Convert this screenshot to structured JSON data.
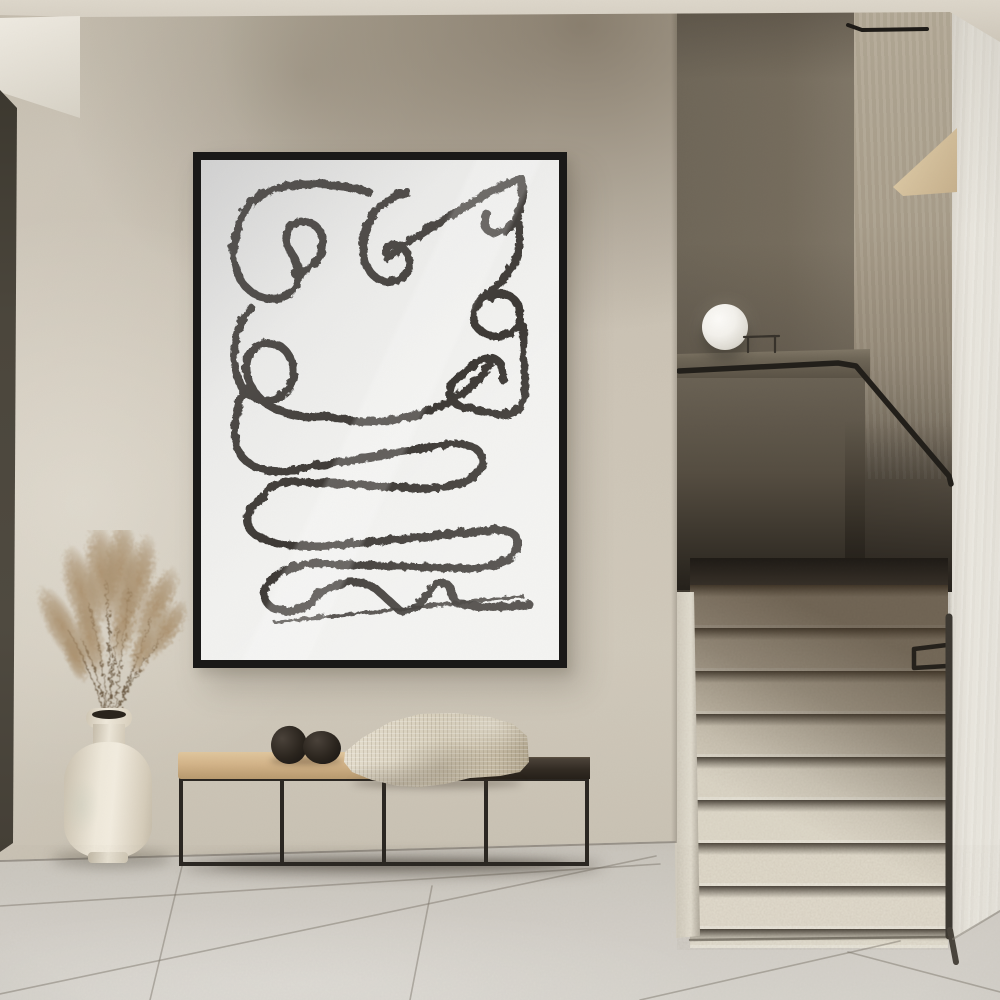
{
  "meta": {
    "type": "interior-photograph",
    "setting": "Minimalist plaster hallway with framed abstract line-art poster, bench styling and terrazzo staircase",
    "text_visible": "none"
  },
  "palette": {
    "ceiling": "#cfc8bb",
    "wall-base": "#cdc5b7",
    "soffit": "#efebe2",
    "door-edge": "#443f36",
    "frame": "#1a1918",
    "mat": "#f2f2f0",
    "ink": "#2d2b28",
    "metal": "#2b2722",
    "cushion": "#d3b489",
    "seat-dark": "#332c24",
    "blanket": "#d8d0bd",
    "stone": "#151210",
    "vase": "#efe9db",
    "pampas": "#aa9070",
    "niche": "#8d8373",
    "niche-light": "#b5ab98",
    "ledge": "#6e6657",
    "rail": "#221f1a",
    "right-wall": "#e9e6de",
    "trim": "#3e3a33",
    "wedge": "#e3d1ad",
    "floor": "#cbc7bf",
    "floor-far": "#bdb8af",
    "seam": "#7a746a",
    "shadow-c": "rgba(60,52,42,0.38)"
  },
  "objects": {
    "artwork": {
      "name": "framed abstract line-art poster",
      "style": "continuous charcoal single-line abstract drawing",
      "frame": "thin black metal frame",
      "mat": "white paper"
    },
    "bench": {
      "name": "black metal frame bench",
      "seat_left": "tan cushion",
      "seat_right": "dark wood top",
      "decor": [
        "black stone left",
        "black stone right",
        "cream waffle-knit throw blanket"
      ]
    },
    "vase": {
      "name": "cream ceramic vase",
      "contents": "dried pampas grass"
    },
    "lamp": {
      "name": "white sphere lamp",
      "location": "stair landing ledge"
    },
    "staircase": {
      "steps_visible": 9,
      "material": "speckled terrazzo",
      "handrail": "black metal handrail",
      "wall_trim": "dark corner trim"
    },
    "floor": {
      "material": "large light stone tiles"
    }
  }
}
